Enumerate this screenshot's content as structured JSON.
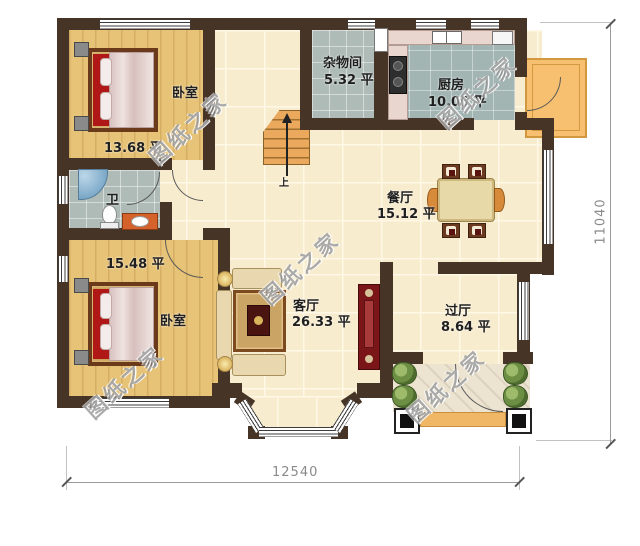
{
  "watermark": "图纸之家",
  "rooms": {
    "bedroom1": {
      "name": "卧室",
      "area": "13.68 平"
    },
    "bathroom": {
      "name": "卫"
    },
    "bedroom2": {
      "name": "卧室",
      "area": "15.48 平"
    },
    "storage": {
      "name": "杂物间",
      "area": "5.32 平"
    },
    "kitchen": {
      "name": "厨房",
      "area": "10.05 平"
    },
    "dining": {
      "name": "餐厅",
      "area": "15.12 平"
    },
    "living": {
      "name": "客厅",
      "area": "26.33 平"
    },
    "hall": {
      "name": "过厅",
      "area": "8.64 平"
    }
  },
  "stairs": {
    "up_label": "上"
  },
  "dimensions": {
    "width_mm": "12540",
    "height_mm": "11040"
  },
  "colors": {
    "wall": "#463527",
    "wood_floor": "#e7c377",
    "hall_tile": "#f8eccf",
    "wet_room_tile": "#aebbb7",
    "balcony": "#f6c070",
    "entry_step": "#f0b766",
    "dimension_text": "#8a8a8a"
  }
}
